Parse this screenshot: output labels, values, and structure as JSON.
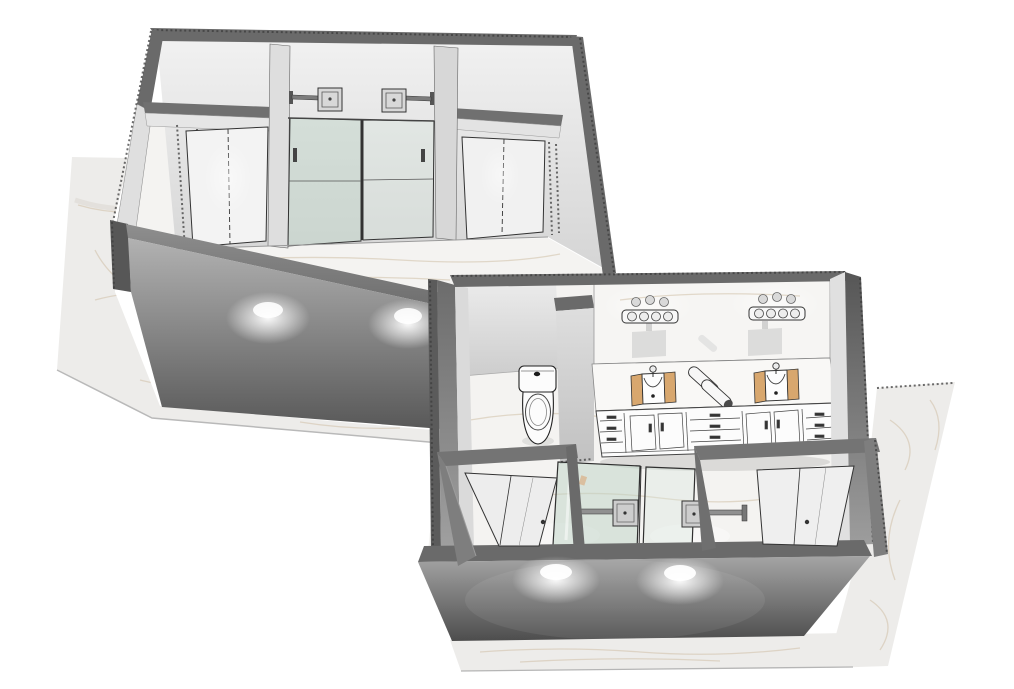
{
  "scene": {
    "type": "3D architectural rendering",
    "subject": "Primary bathroom design - two axonometric cutaway views of the same room",
    "views": [
      {
        "id": "upper-left",
        "label": "Interior view of shower wall",
        "objects": [
          "entry-door-left",
          "entry-door-right",
          "glass-double-shower",
          "rain-shower-head-left",
          "rain-shower-head-right",
          "cutaway-walls",
          "marble-floor",
          "downlight-glows"
        ]
      },
      {
        "id": "lower-right",
        "label": "Overhead cutaway overview",
        "objects": [
          "toilet-compartment",
          "toilet",
          "divider-wall",
          "vanity-mirror",
          "vanity-light-left",
          "vanity-light-right",
          "vanity-counter",
          "sink-left",
          "sink-right",
          "rolled-towels",
          "vanity-cabinets",
          "glass-double-shower",
          "rain-shower-head-left",
          "rain-shower-head-right",
          "entry-door-left",
          "entry-door-right",
          "front-wall-downlights",
          "marble-floor"
        ]
      }
    ],
    "palette": {
      "bg": "#ffffff",
      "outline": "#2e2e2e",
      "cap": "#6a6a6a",
      "cap_dark": "#575757",
      "wall_hi": "#f0f0f0",
      "wall_lo": "#d6d6d6",
      "floor": "#edecea",
      "floor_hi": "#f4f3f1",
      "vein": "#cfc0a6",
      "glass": "#bdd3c6",
      "glass_lite": "#d8e6dd",
      "wood": "#d8a76e",
      "fixture_white": "#f8f8f8",
      "metal": "#8f8f8f"
    }
  }
}
